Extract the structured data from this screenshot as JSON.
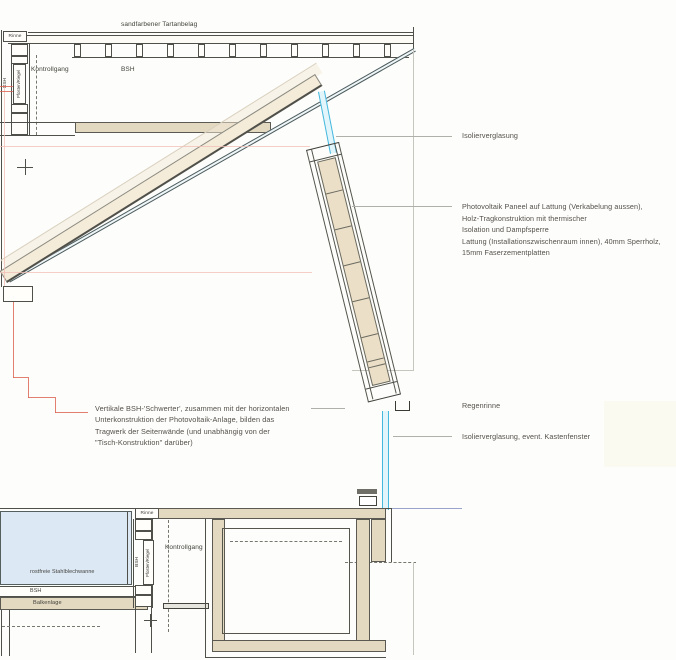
{
  "drawing": {
    "top": {
      "tartanbelag": "sandfarbener Tartanbelag",
      "rinne": "Rinne",
      "bsh_vertical": "BSH",
      "pfosten_riegel": "Pfosten/Riegel",
      "kontrollgang": "Kontrollgang",
      "bsh": "BSH"
    },
    "bottom": {
      "rinne": "Rinne",
      "bsh_vertical": "BSH",
      "pfosten_riegel": "Pfosten/Riegel",
      "kontrollgang": "Kontrollgang",
      "stahlblechwanne": "rostfreie Stahlblechwanne",
      "bsh": "BSH",
      "balkenlage": "Balkenlage"
    }
  },
  "annotations": {
    "isolierverglasung": "Isolierverglasung",
    "photovoltaik": [
      "Photovoltaik Paneel auf Lattung (Verkabelung aussen),",
      "Holz-Tragkonstruktion mit thermischer",
      "Isolation und Dampfsperre",
      "Lattung (Installationszwischenraum innen), 40mm Sperrholz,",
      "15mm Faserzementplatten"
    ],
    "schwerter": [
      "Vertikale BSH-'Schwerter', zusammen mit der horizontalen",
      "Unterkonstruktion der Photovoltaik-Anlage, bilden das",
      "Tragwerk der Seitenwände (und unabhängig von der",
      "\"Tisch-Konstruktion\" darüber)"
    ],
    "regenrinne": "Regenrinne",
    "isolierverglasung_kastenfenster": "Isolierverglasung, event. Kastenfenster"
  },
  "colors": {
    "wood_tan": "#e3d8c0",
    "beam_cream": "#f4ebd9",
    "panel_fill": "#ecdfc8",
    "glazing_cyan": "#45b8de",
    "basin_blue": "#dce8f4",
    "axis_purple": "#9aa3cc",
    "construction_red": "#d9604f",
    "line_dark": "#50504a",
    "text_gray": "#54504b"
  }
}
